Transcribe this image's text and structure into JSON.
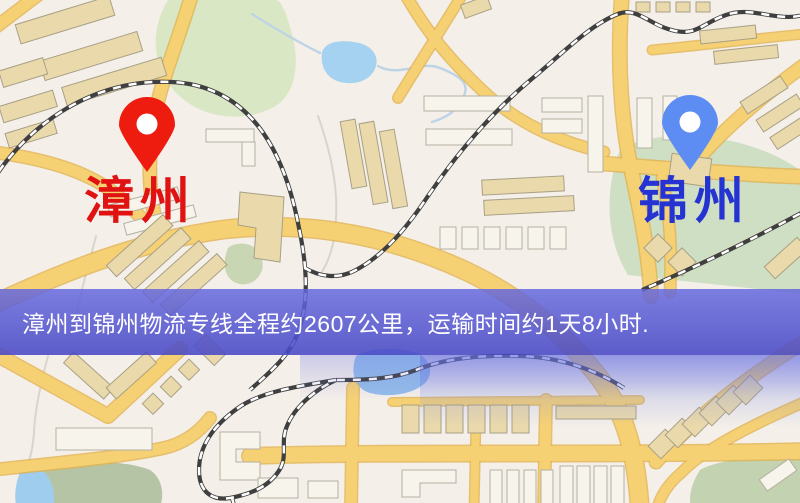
{
  "map": {
    "markers": [
      {
        "id": "origin",
        "label": "漳州",
        "icon": "red-map-pin-icon",
        "pin_color": "#ee1c0f",
        "label_color": "#e01212"
      },
      {
        "id": "destination",
        "label": "锦州",
        "icon": "blue-map-pin-icon",
        "pin_color": "#5d8df2",
        "label_color": "#2433d2"
      }
    ],
    "palette": {
      "background": "#f4efe9",
      "road": "#f6d173",
      "park": "#d9e7c4",
      "water": "#a6d2f1",
      "railway": "#3f3f3f"
    }
  },
  "banner": {
    "text": "漳州到锦州物流专线全程约2607公里，运输时间约1天8小时.",
    "background_color": "#5556cf",
    "text_color": "#ffffff"
  }
}
